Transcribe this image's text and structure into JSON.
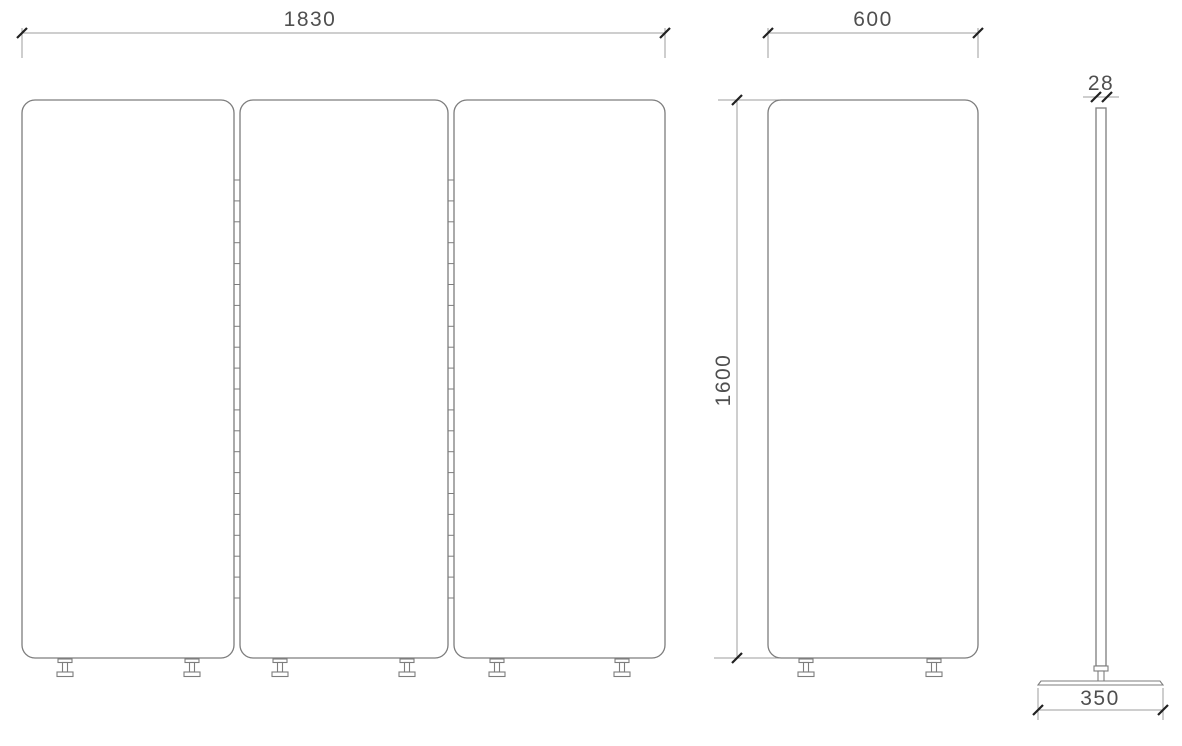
{
  "drawing": {
    "colors": {
      "background": "#ffffff",
      "outline": "#7d7d7d",
      "dimension_line": "#9c9c9c",
      "tick": "#212121",
      "label": "#4f4f4f"
    },
    "views": {
      "front_three_panel": {
        "panels": 3,
        "feet": 6,
        "hinge_strips": 2,
        "overall_width": {
          "label": "1830"
        }
      },
      "single_panel": {
        "feet": 2,
        "width": {
          "label": "600"
        },
        "height": {
          "label": "1600"
        }
      },
      "side_profile": {
        "thickness": {
          "label": "28"
        },
        "base_width": {
          "label": "350"
        }
      }
    }
  }
}
